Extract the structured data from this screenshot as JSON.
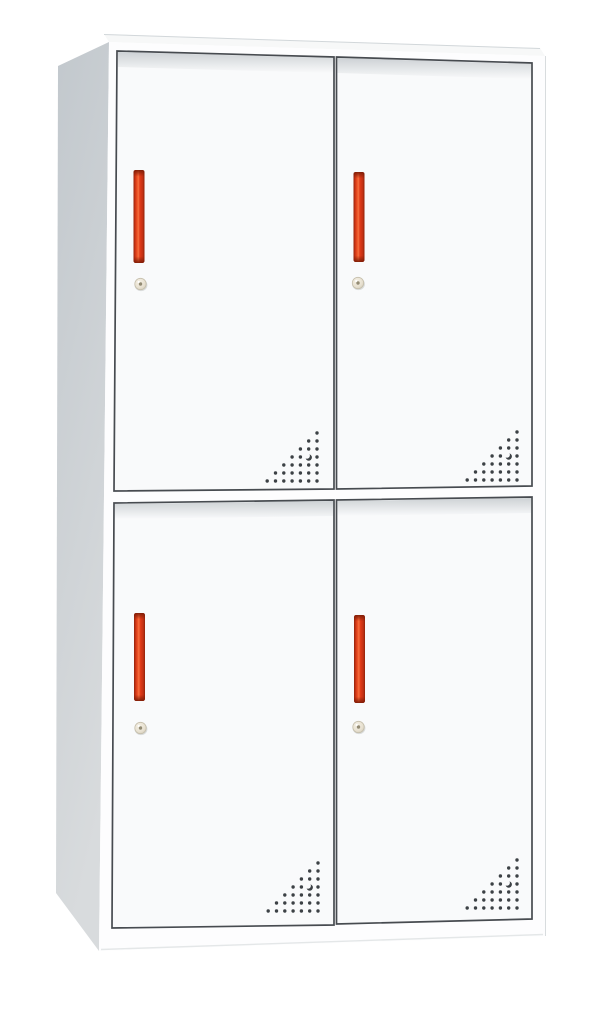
{
  "image": {
    "kind": "product photo",
    "subject": "White 4-door steel locker cabinet (2 tiers x 2 columns) with red vertical handles, round cam locks and triangular perforated air vents",
    "background_color": "#ffffff"
  },
  "colors": {
    "background": "#ffffff",
    "side_panel_top": "#c2c8cd",
    "side_panel_bottom": "#d8dbdd",
    "top_panel": "#f7f8f8",
    "top_back_edge": "#d2d7da",
    "face": "#fdfdfe",
    "face_right_edge": "#d8dcde",
    "plinth_edge": "#e4e7e8",
    "door_fill": "#f9fafb",
    "door_border": "#474b50",
    "door_top_shadow": "#98a0a6",
    "handle_edge_dark": "#8f2209",
    "handle_dark": "#c23013",
    "handle_bright": "#ee4e22",
    "handle_highlight": "#f4703f",
    "handle_red": "#e23a18",
    "handle_cap": "#7c1c06",
    "lock_highlight": "#f6f1e6",
    "lock_fill": "#e7e0d0",
    "lock_rim": "#cdc6b3",
    "lock_edge": "#c5beab",
    "lock_center": "#938b74",
    "vent_dot": "#3c4145"
  },
  "cabinet": {
    "columns": 2,
    "tiers": 2,
    "doors": [
      {
        "id": "top-left",
        "handle": true,
        "lock": true,
        "vent": true
      },
      {
        "id": "top-right",
        "handle": true,
        "lock": true,
        "vent": true
      },
      {
        "id": "bottom-left",
        "handle": true,
        "lock": true,
        "vent": true
      },
      {
        "id": "bottom-right",
        "handle": true,
        "lock": true,
        "vent": true
      }
    ],
    "vent_pattern": {
      "rows": 7,
      "layout": "right-angled triangle of round holes, right-aligned, one dot added per row",
      "crescent_row": 4,
      "crescent_col_from_right": 2
    }
  }
}
